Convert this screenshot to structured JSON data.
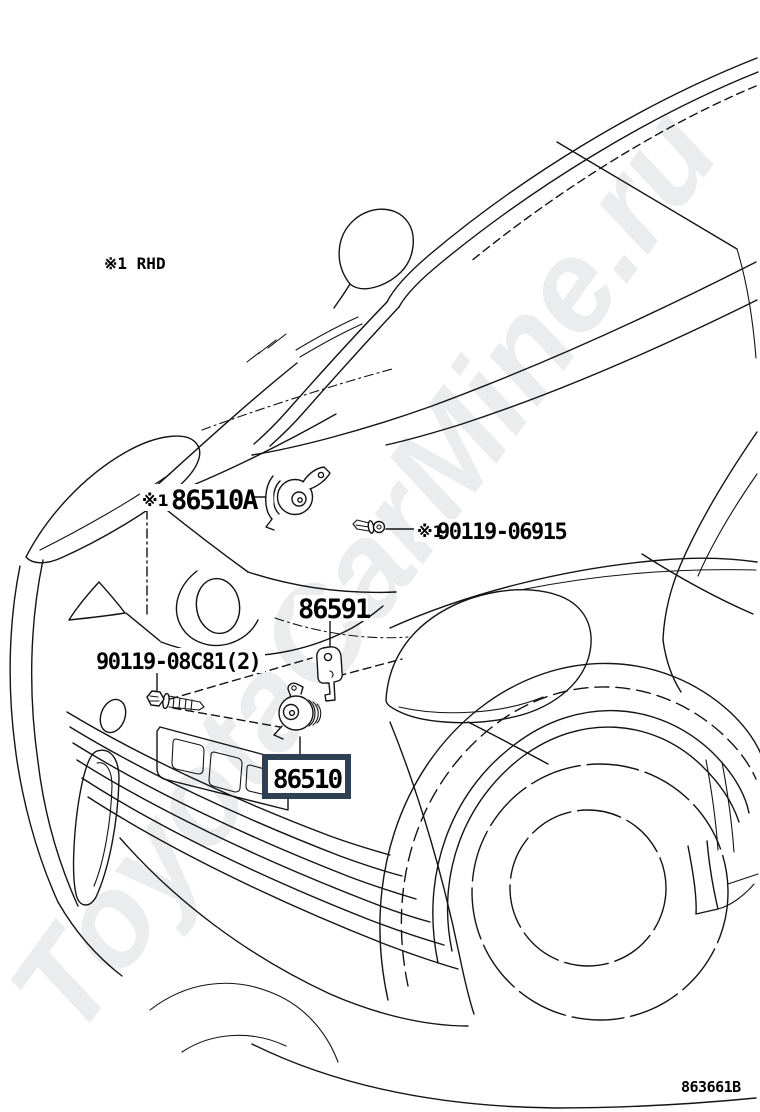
{
  "watermark": {
    "text": "ToyotaCarMine.ru",
    "color": "#ebecee"
  },
  "footnote": "※1 RHD",
  "drawing_code": "863661B",
  "line_color": "#141414",
  "parts": {
    "horn_a": {
      "prefix": "※1",
      "number": "86510A"
    },
    "screw": {
      "prefix": "※1",
      "number": "90119-06915"
    },
    "bracket": {
      "number": "86591"
    },
    "bolt": {
      "number": "90119-08C81(2)"
    },
    "horn_main": {
      "number": "86510",
      "highlighted": true,
      "box_color": "#2e4053"
    }
  }
}
